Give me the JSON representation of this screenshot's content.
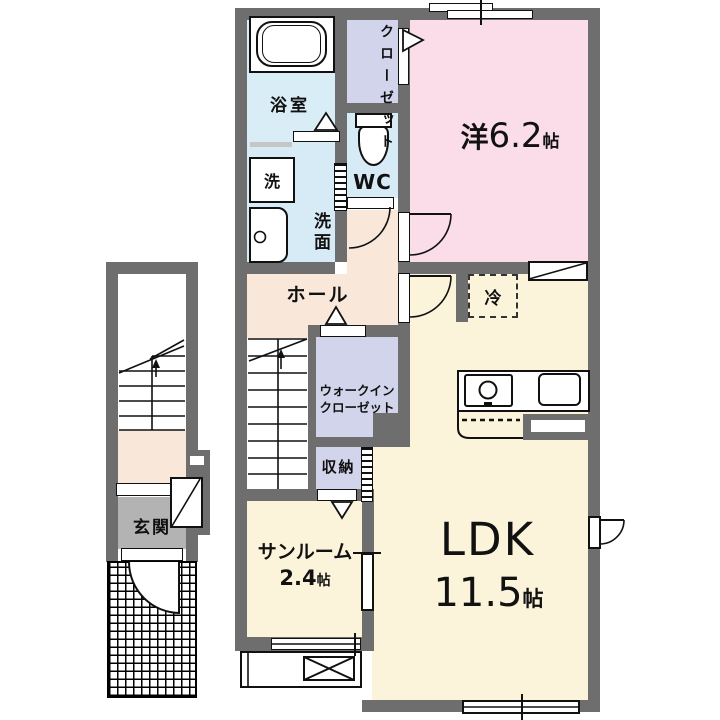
{
  "title": "apartment-floor-plan",
  "rooms": {
    "bathroom": {
      "label": "浴室"
    },
    "washer": {
      "label": "洗"
    },
    "washroom": {
      "label": "洗面"
    },
    "wc": {
      "label": "WC"
    },
    "closet": {
      "label": "クローゼット"
    },
    "western_room": {
      "label": "洋",
      "size": "6.2",
      "unit": "帖"
    },
    "hall": {
      "label": "ホール"
    },
    "walk_in_closet": {
      "line1": "ウォークイン",
      "line2": "クローゼット"
    },
    "storage": {
      "label": "収納"
    },
    "refrigerator": {
      "label": "冷"
    },
    "ldk": {
      "label": "LDK",
      "size": "11.5",
      "unit": "帖"
    },
    "sunroom": {
      "label": "サンルーム",
      "size": "2.4",
      "unit": "帖"
    },
    "entrance": {
      "label": "玄関"
    }
  },
  "colors": {
    "wall": "#6e6e6e",
    "water_rooms": "#d6ebf5",
    "closets": "#d2d4eb",
    "western_room": "#fadde8",
    "hall": "#f9e7da",
    "ldk": "#fbf4da",
    "entrance_floor": "#b3b3b3"
  }
}
